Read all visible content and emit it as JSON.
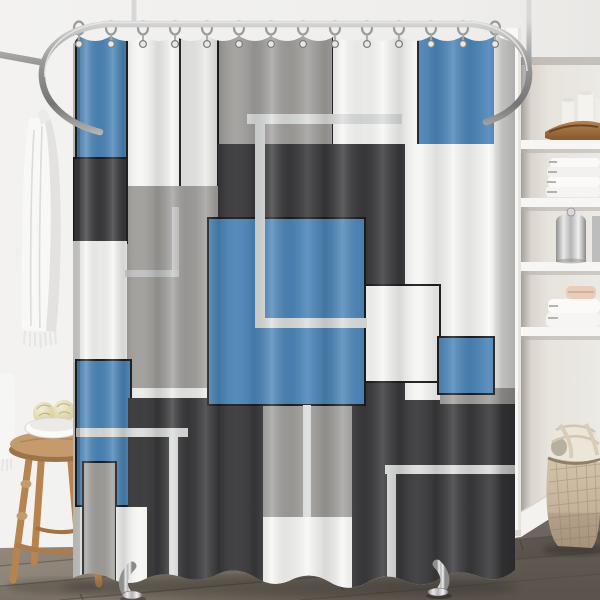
{
  "image": {
    "type": "product-photo",
    "subject": "geometric color-block shower curtain hanging from oval chrome rail in styled bathroom",
    "width": 600,
    "height": 600
  },
  "palette": {
    "blue": "#4c86b9",
    "dark": "#3a393b",
    "gray": "#a2a09d",
    "white": "#f7f7f6",
    "white_dim": "#ebebe9",
    "border": "#1c1c1f",
    "line": "#dcdedd",
    "line_faint": "#c9cbca",
    "wall": "#f1f0ee",
    "niche_wall": "#e6e2dc",
    "floor_light": "#a4988a",
    "floor_dark": "#6e665d",
    "stool_wood": "#c09467",
    "basket_weave": "#c9b7a0",
    "chrome": "#9b9b9b"
  },
  "curtain": {
    "x": 73,
    "y": 30,
    "width": 442,
    "height": 565,
    "hooks": {
      "count": 14,
      "first_x": 79,
      "spacing": 32,
      "rail_y": 24,
      "ring_y": 28,
      "grommet_y": 44
    },
    "panels": [
      {
        "id": "base",
        "x": 0,
        "y": 0,
        "w": 442,
        "h": 565,
        "c": "white_dim"
      },
      {
        "id": "white-col-a",
        "x": 49,
        "y": 0,
        "w": 60,
        "h": 158,
        "c": "white",
        "b": 1
      },
      {
        "id": "white-col-b",
        "x": 107,
        "y": 0,
        "w": 38,
        "h": 158,
        "c": "white_dim",
        "b": 1
      },
      {
        "id": "gray-left-mid",
        "x": 49,
        "y": 156,
        "w": 96,
        "h": 202,
        "c": "gray"
      },
      {
        "id": "gray-top",
        "x": 145,
        "y": 0,
        "w": 115,
        "h": 116,
        "c": "gray",
        "b": 1
      },
      {
        "id": "white-top-mid",
        "x": 260,
        "y": 0,
        "w": 85,
        "h": 145,
        "c": "white"
      },
      {
        "id": "blue-top-right",
        "x": 345,
        "y": 0,
        "w": 78,
        "h": 116,
        "c": "blue",
        "b": 1
      },
      {
        "id": "white-edge-right",
        "x": 421,
        "y": 0,
        "w": 21,
        "h": 372,
        "c": "white_dim"
      },
      {
        "id": "white-right-region",
        "x": 330,
        "y": 114,
        "w": 91,
        "h": 286,
        "c": "white"
      },
      {
        "id": "blue-top-left",
        "x": 3,
        "y": 0,
        "w": 51,
        "h": 130,
        "c": "blue",
        "b": 1
      },
      {
        "id": "dark-left",
        "x": 0,
        "y": 128,
        "w": 54,
        "h": 85,
        "c": "dark",
        "b": 1
      },
      {
        "id": "white-left",
        "x": 0,
        "y": 211,
        "w": 54,
        "h": 122,
        "c": "white"
      },
      {
        "id": "dark-center",
        "x": 145,
        "y": 114,
        "w": 187,
        "h": 112,
        "c": "dark"
      },
      {
        "id": "dark-col-mid",
        "x": 290,
        "y": 114,
        "w": 42,
        "h": 276,
        "c": "dark"
      },
      {
        "id": "blue-bottom-left",
        "x": 3,
        "y": 330,
        "w": 55,
        "h": 146,
        "c": "blue",
        "b": 1
      },
      {
        "id": "dark-bottom-left",
        "x": 55,
        "y": 368,
        "w": 141,
        "h": 197,
        "c": "dark"
      },
      {
        "id": "gray-bottom-left",
        "x": 10,
        "y": 432,
        "w": 33,
        "h": 133,
        "c": "gray",
        "b": 1
      },
      {
        "id": "white-bottom-left",
        "x": 43,
        "y": 477,
        "w": 31,
        "h": 88,
        "c": "white"
      },
      {
        "id": "gray-bottom-center",
        "x": 190,
        "y": 375,
        "w": 122,
        "h": 112,
        "c": "gray"
      },
      {
        "id": "white-bottom-center",
        "x": 190,
        "y": 487,
        "w": 122,
        "h": 78,
        "c": "white"
      },
      {
        "id": "dark-bottom-right",
        "x": 279,
        "y": 370,
        "w": 163,
        "h": 195,
        "c": "dark"
      },
      {
        "id": "gray-bar-right",
        "x": 367,
        "y": 358,
        "w": 75,
        "h": 16,
        "c": "gray"
      },
      {
        "id": "white-panel-right",
        "x": 292,
        "y": 255,
        "w": 75,
        "h": 97,
        "c": "white",
        "b": 1
      },
      {
        "id": "blue-small-right",
        "x": 365,
        "y": 307,
        "w": 56,
        "h": 57,
        "c": "blue",
        "b": 1
      },
      {
        "id": "blue-square-center",
        "x": 135,
        "y": 188,
        "w": 157,
        "h": 187,
        "c": "blue",
        "b": 1
      }
    ],
    "accent_lines": [
      {
        "id": "line-top-horizontal",
        "x": 174,
        "y": 84,
        "w": 155,
        "h": 10
      },
      {
        "id": "line-center-vertical",
        "x": 182,
        "y": 84,
        "w": 10,
        "h": 214
      },
      {
        "id": "line-bluesq-horizontal",
        "x": 182,
        "y": 288,
        "w": 112,
        "h": 10
      },
      {
        "id": "line-lowleft-horizontal",
        "x": 3,
        "y": 398,
        "w": 112,
        "h": 9
      },
      {
        "id": "line-lowleft-vertical",
        "x": 96,
        "y": 398,
        "w": 9,
        "h": 167
      },
      {
        "id": "line-lowright-horizontal",
        "x": 312,
        "y": 435,
        "w": 130,
        "h": 9
      },
      {
        "id": "line-lowright-vertical",
        "x": 314,
        "y": 435,
        "w": 9,
        "h": 130
      },
      {
        "id": "line-graypanel-vertical",
        "x": 230,
        "y": 375,
        "w": 8,
        "h": 112
      },
      {
        "id": "line-faint-vertical",
        "x": 99,
        "y": 177,
        "w": 7,
        "h": 70,
        "f": 1
      },
      {
        "id": "line-faint-horizontal",
        "x": 52,
        "y": 240,
        "w": 54,
        "h": 7,
        "f": 1
      }
    ]
  },
  "objects": {
    "rod": "oval ceiling-mounted chrome shower rod with two ceiling posts",
    "hooks": "chrome rings with grommets",
    "left_side": [
      "white hanging towel with fringe on wall hook",
      "second towel edge at frame left",
      "round wooden stool",
      "white bowl with two bath sponges"
    ],
    "right_side": {
      "shelving": [
        "white pillar candles",
        "long wooden tray",
        "stack of folded white towels",
        "polished metal canisters",
        "folded towels with soap bar"
      ],
      "floor_items": [
        "woven two-tone basket with cream blanket"
      ],
      "trim": [
        "white door casing",
        "white baseboard"
      ]
    },
    "floor": "rustic gray-brown wood planks laid diagonally",
    "feet": "two chrome tub feet visible under curtain hem"
  }
}
